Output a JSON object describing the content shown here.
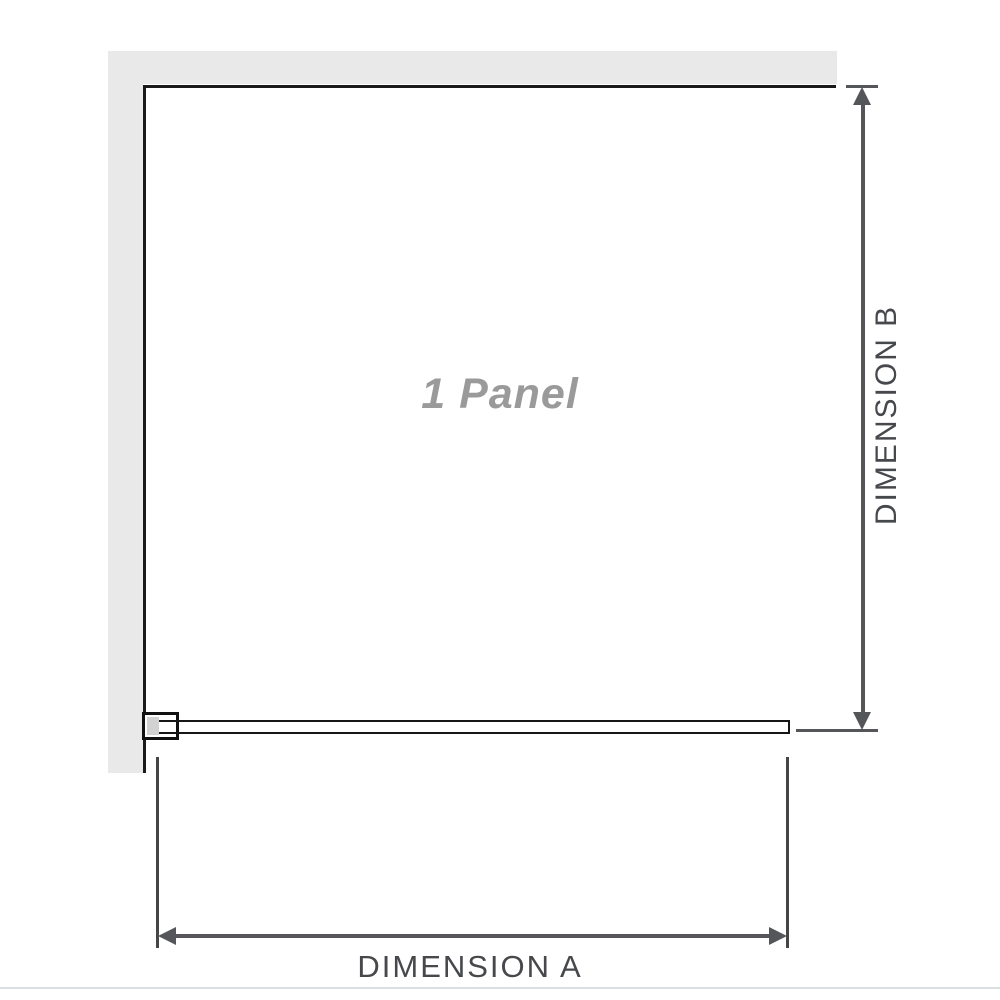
{
  "diagram": {
    "title": "1 Panel",
    "dimensions": {
      "a": {
        "label": "DIMENSION A"
      },
      "b": {
        "label": "DIMENSION B"
      }
    }
  },
  "colors": {
    "wall": "#e9e9e9",
    "panel_border": "#1a1a1a",
    "glass_green_light": "#eef8f2",
    "glass_green": "#b9e4c9",
    "glass_green_dark": "#6fa485",
    "bracket_fill": "#d2d2d2",
    "arrow": "#55565a",
    "label_text": "#46484c",
    "panel_label_text": "#9a9a9a",
    "separator": "#d9dee2"
  }
}
